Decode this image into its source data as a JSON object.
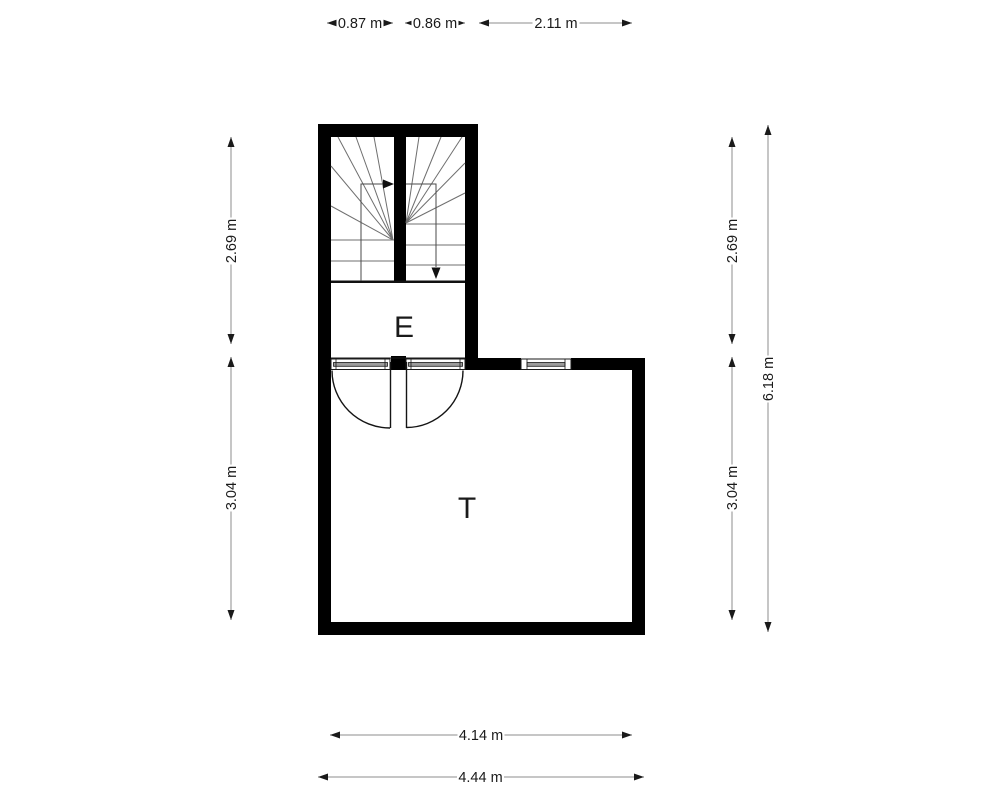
{
  "floorplan": {
    "rooms": [
      {
        "id": "E",
        "label": "E"
      },
      {
        "id": "T",
        "label": "T"
      }
    ],
    "dimensions": {
      "top": [
        {
          "label": "0.87 m"
        },
        {
          "label": "0.86 m"
        },
        {
          "label": "2.11 m"
        }
      ],
      "left": [
        {
          "label": "2.69 m"
        },
        {
          "label": "3.04 m"
        }
      ],
      "right_inner": [
        {
          "label": "2.69 m"
        },
        {
          "label": "3.04 m"
        }
      ],
      "right_outer": [
        {
          "label": "6.18 m"
        }
      ],
      "bottom": [
        {
          "label": "4.14 m"
        },
        {
          "label": "4.44 m"
        }
      ]
    },
    "colors": {
      "wall": "#000000",
      "dimension_line": "#8c8c8c",
      "stair_line": "#6f6f6f",
      "window_glass": "#9b9b9b",
      "text": "#1a1a1a",
      "background": "#ffffff"
    }
  }
}
